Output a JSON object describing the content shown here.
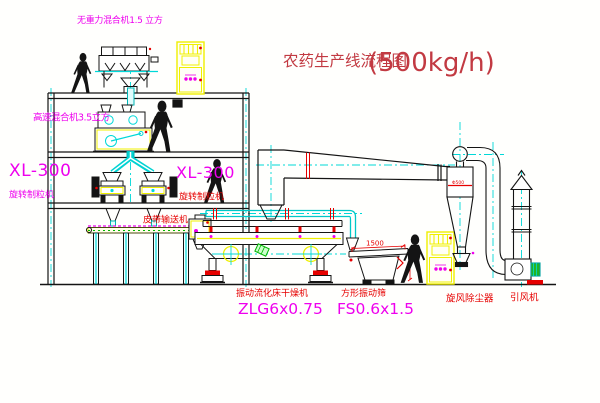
{
  "title": {
    "text": "农药生产线流程图",
    "capacity": "(500kg/h)"
  },
  "equipment_labels": {
    "gravity_mixer": "无重力混合机1.5 立方",
    "high_speed_mixer": "高速混合机3.5立方",
    "granulator_left_model": "XL-300",
    "granulator_left_name": "旋转制粒机",
    "granulator_mid_model": "XL-300",
    "granulator_mid_name": "旋转制粒机",
    "belt_conveyor": "皮带输送机",
    "fluid_bed_dryer_name": "振动流化床干燥机",
    "fluid_bed_dryer_model": "ZLG6x0.75",
    "vibrating_screen_name": "方形振动筛",
    "vibrating_screen_model": "FS0.6x1.5",
    "cyclone_name": "旋风除尘器",
    "fan_name": "引风机"
  },
  "dimensions": {
    "screen_length": "1500",
    "cyclone_dia": "Φ500"
  },
  "colors": {
    "magenta": "#ee00ee",
    "red_label": "#e60000",
    "title_red": "#c23a42",
    "cyan": "#00d8d8",
    "yellow": "#f0f000",
    "green": "#00b400",
    "line_black": "#141414"
  }
}
